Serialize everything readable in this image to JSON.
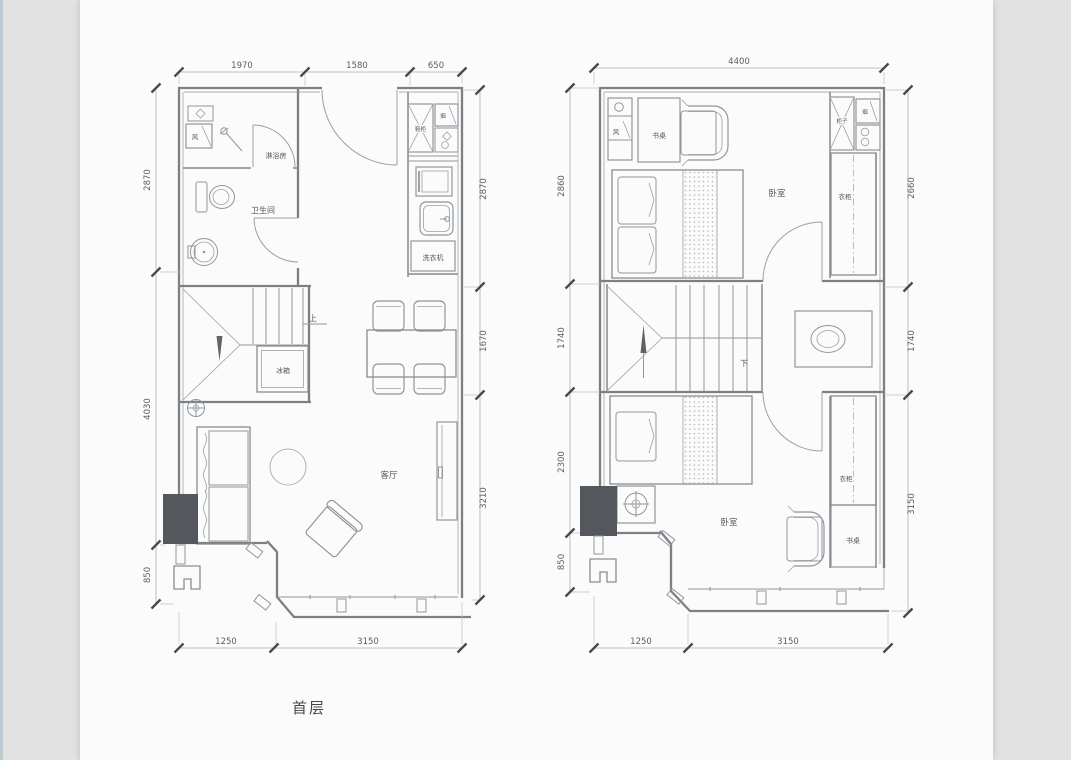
{
  "page": {
    "floor_label": "首层"
  },
  "colors": {
    "background": "#e2e2e2",
    "paper": "#fbfbfb",
    "accent_strip": "#b9cbd4",
    "wall_line": "#7b8084",
    "fixture_line": "#91969b",
    "dim_text": "#5a5e62",
    "dark_block": "#54575b"
  },
  "plan_left": {
    "labels": {
      "vent": "风",
      "shower_room": "淋浴房",
      "bathroom": "卫生间",
      "shoe_cabinet": "鞋柜",
      "flue": "烟",
      "washing_machine": "洗衣机",
      "stairs_up": "上",
      "fridge": "冰箱",
      "living_room": "客厅"
    },
    "dims": {
      "top": [
        "1970",
        "1580",
        "650"
      ],
      "left": [
        "2870",
        "4030",
        "850"
      ],
      "right": [
        "2870",
        "1670",
        "3210"
      ],
      "bottom": [
        "1250",
        "3150"
      ]
    }
  },
  "plan_right": {
    "labels": {
      "vent": "风",
      "desk_top": "书桌",
      "bedroom_top": "卧室",
      "cabinet": "柜子",
      "flue": "烟",
      "wardrobe_top": "衣柜",
      "stairs_down": "下",
      "bedroom_bottom": "卧室",
      "desk_bottom": "书桌",
      "wardrobe_bottom": "衣柜"
    },
    "dims": {
      "top": [
        "4400"
      ],
      "left": [
        "2860",
        "1740",
        "2300",
        "850"
      ],
      "right": [
        "2660",
        "1740",
        "3150"
      ],
      "bottom": [
        "1250",
        "3150"
      ]
    }
  }
}
